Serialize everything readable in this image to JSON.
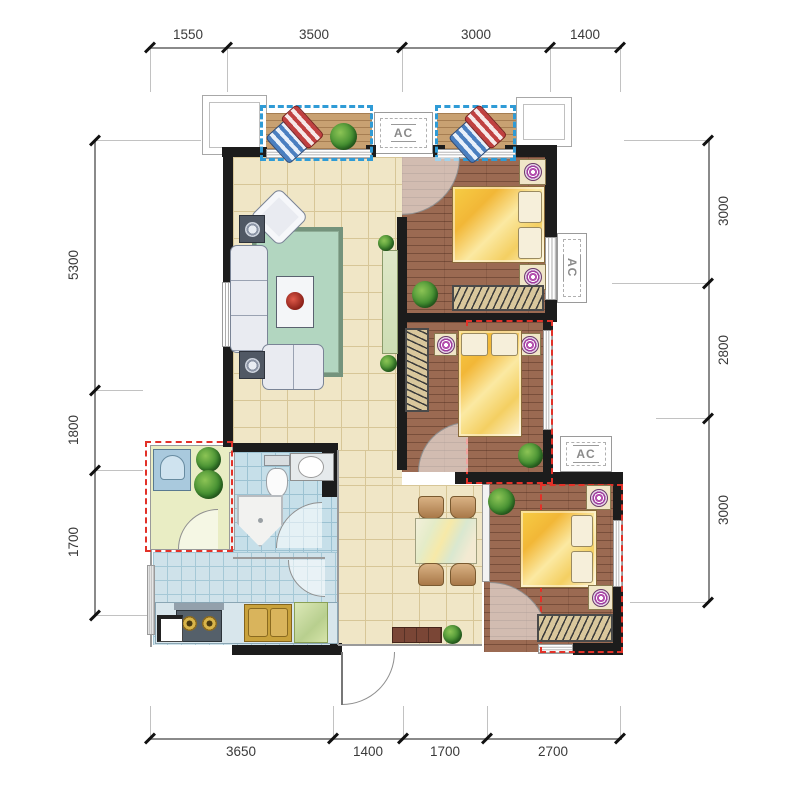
{
  "dimensions": {
    "top": [
      "1550",
      "3500",
      "3000",
      "1400"
    ],
    "bottom": [
      "3650",
      "1400",
      "1700",
      "2700"
    ],
    "left": [
      "5300",
      "1800",
      "1700"
    ],
    "right": [
      "3000",
      "2800",
      "3000"
    ]
  },
  "labels": {
    "ac": "AC"
  },
  "colors": {
    "wall": "#1c1c1c",
    "balcony_dash": "#2f9bd6",
    "highlight_dash": "#e23128",
    "living_tile": "#f0e6c6",
    "bedroom_wood": "#9b6a52",
    "balcony_wood": "#c8a172",
    "bathroom_tile": "#c6dfe9",
    "kitchen_tile": "#cfe2ea",
    "laundry_floor": "#e9edc4",
    "rug": "#b2d6c0"
  }
}
